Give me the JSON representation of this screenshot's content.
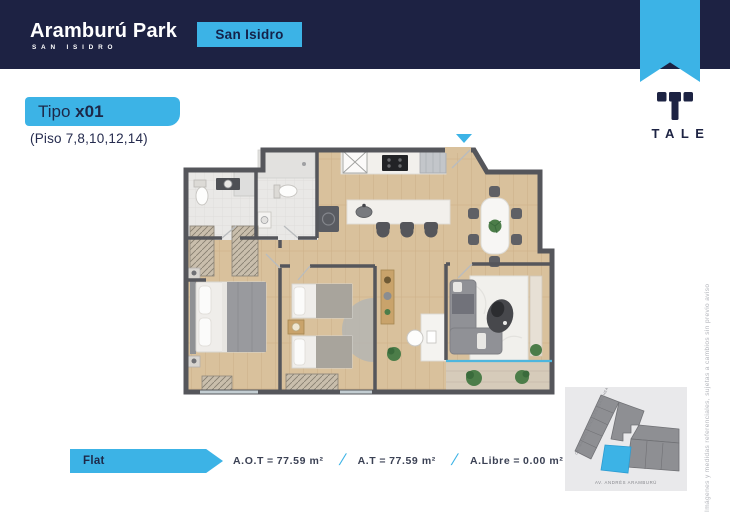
{
  "header": {
    "brand_name": "Aramburú Park",
    "brand_subtitle": "SAN ISIDRO",
    "location_badge": "San Isidro"
  },
  "developer_logo": {
    "text": "TALE"
  },
  "unit": {
    "type_prefix": "Tipo ",
    "type_code": "x01",
    "floors_note": "(Piso 7,8,10,12,14)"
  },
  "specs": {
    "category": "Flat",
    "equals": "=",
    "separator": "/",
    "areas": [
      {
        "label": "A.O.T",
        "value": "77.59 m²"
      },
      {
        "label": "A.T",
        "value": "77.59 m²"
      },
      {
        "label": "A.Libre",
        "value": "0.00 m²"
      }
    ]
  },
  "map": {
    "street_left": "CA. MANUEL GONZALES OLAECHEA",
    "street_bottom": "AV. ANDRÉS ARAMBURÚ"
  },
  "disclaimer": "Imágenes y medidas referenciales, sujetas a cambios sin previo aviso",
  "colors": {
    "navy": "#1d2243",
    "cyan": "#3cb3e6",
    "wall": "#55565b",
    "wood": "#d9c19c",
    "tile": "#e9e8e6"
  }
}
